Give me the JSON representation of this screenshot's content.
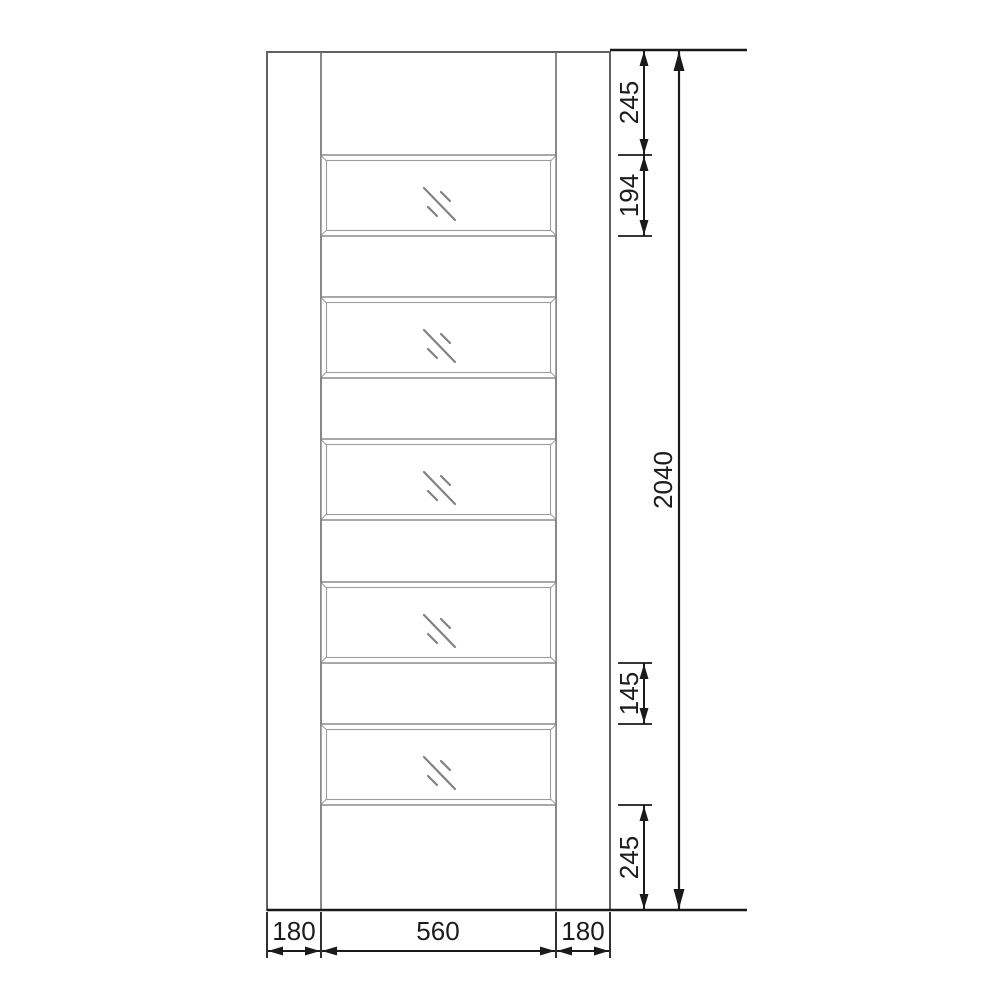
{
  "drawing": {
    "kind": "door-elevation-technical-drawing",
    "panels": {
      "count": 5
    },
    "icons": {
      "glass_mark": "diagonal-hatch-glazing"
    },
    "colors": {
      "background": "#ffffff",
      "door_line": "#616161",
      "panel_line": "#7a7a7a",
      "panel_inner_line": "#9c9c9c",
      "glass_mark": "#828282",
      "dimension_line": "#1a1a1a"
    }
  },
  "dims": {
    "top_rail": "245",
    "top_panel": "194",
    "overall_height": "2040",
    "mid_rail": "145",
    "bottom_rail": "245",
    "left_stile": "180",
    "glazed_width": "560",
    "right_stile": "180"
  }
}
